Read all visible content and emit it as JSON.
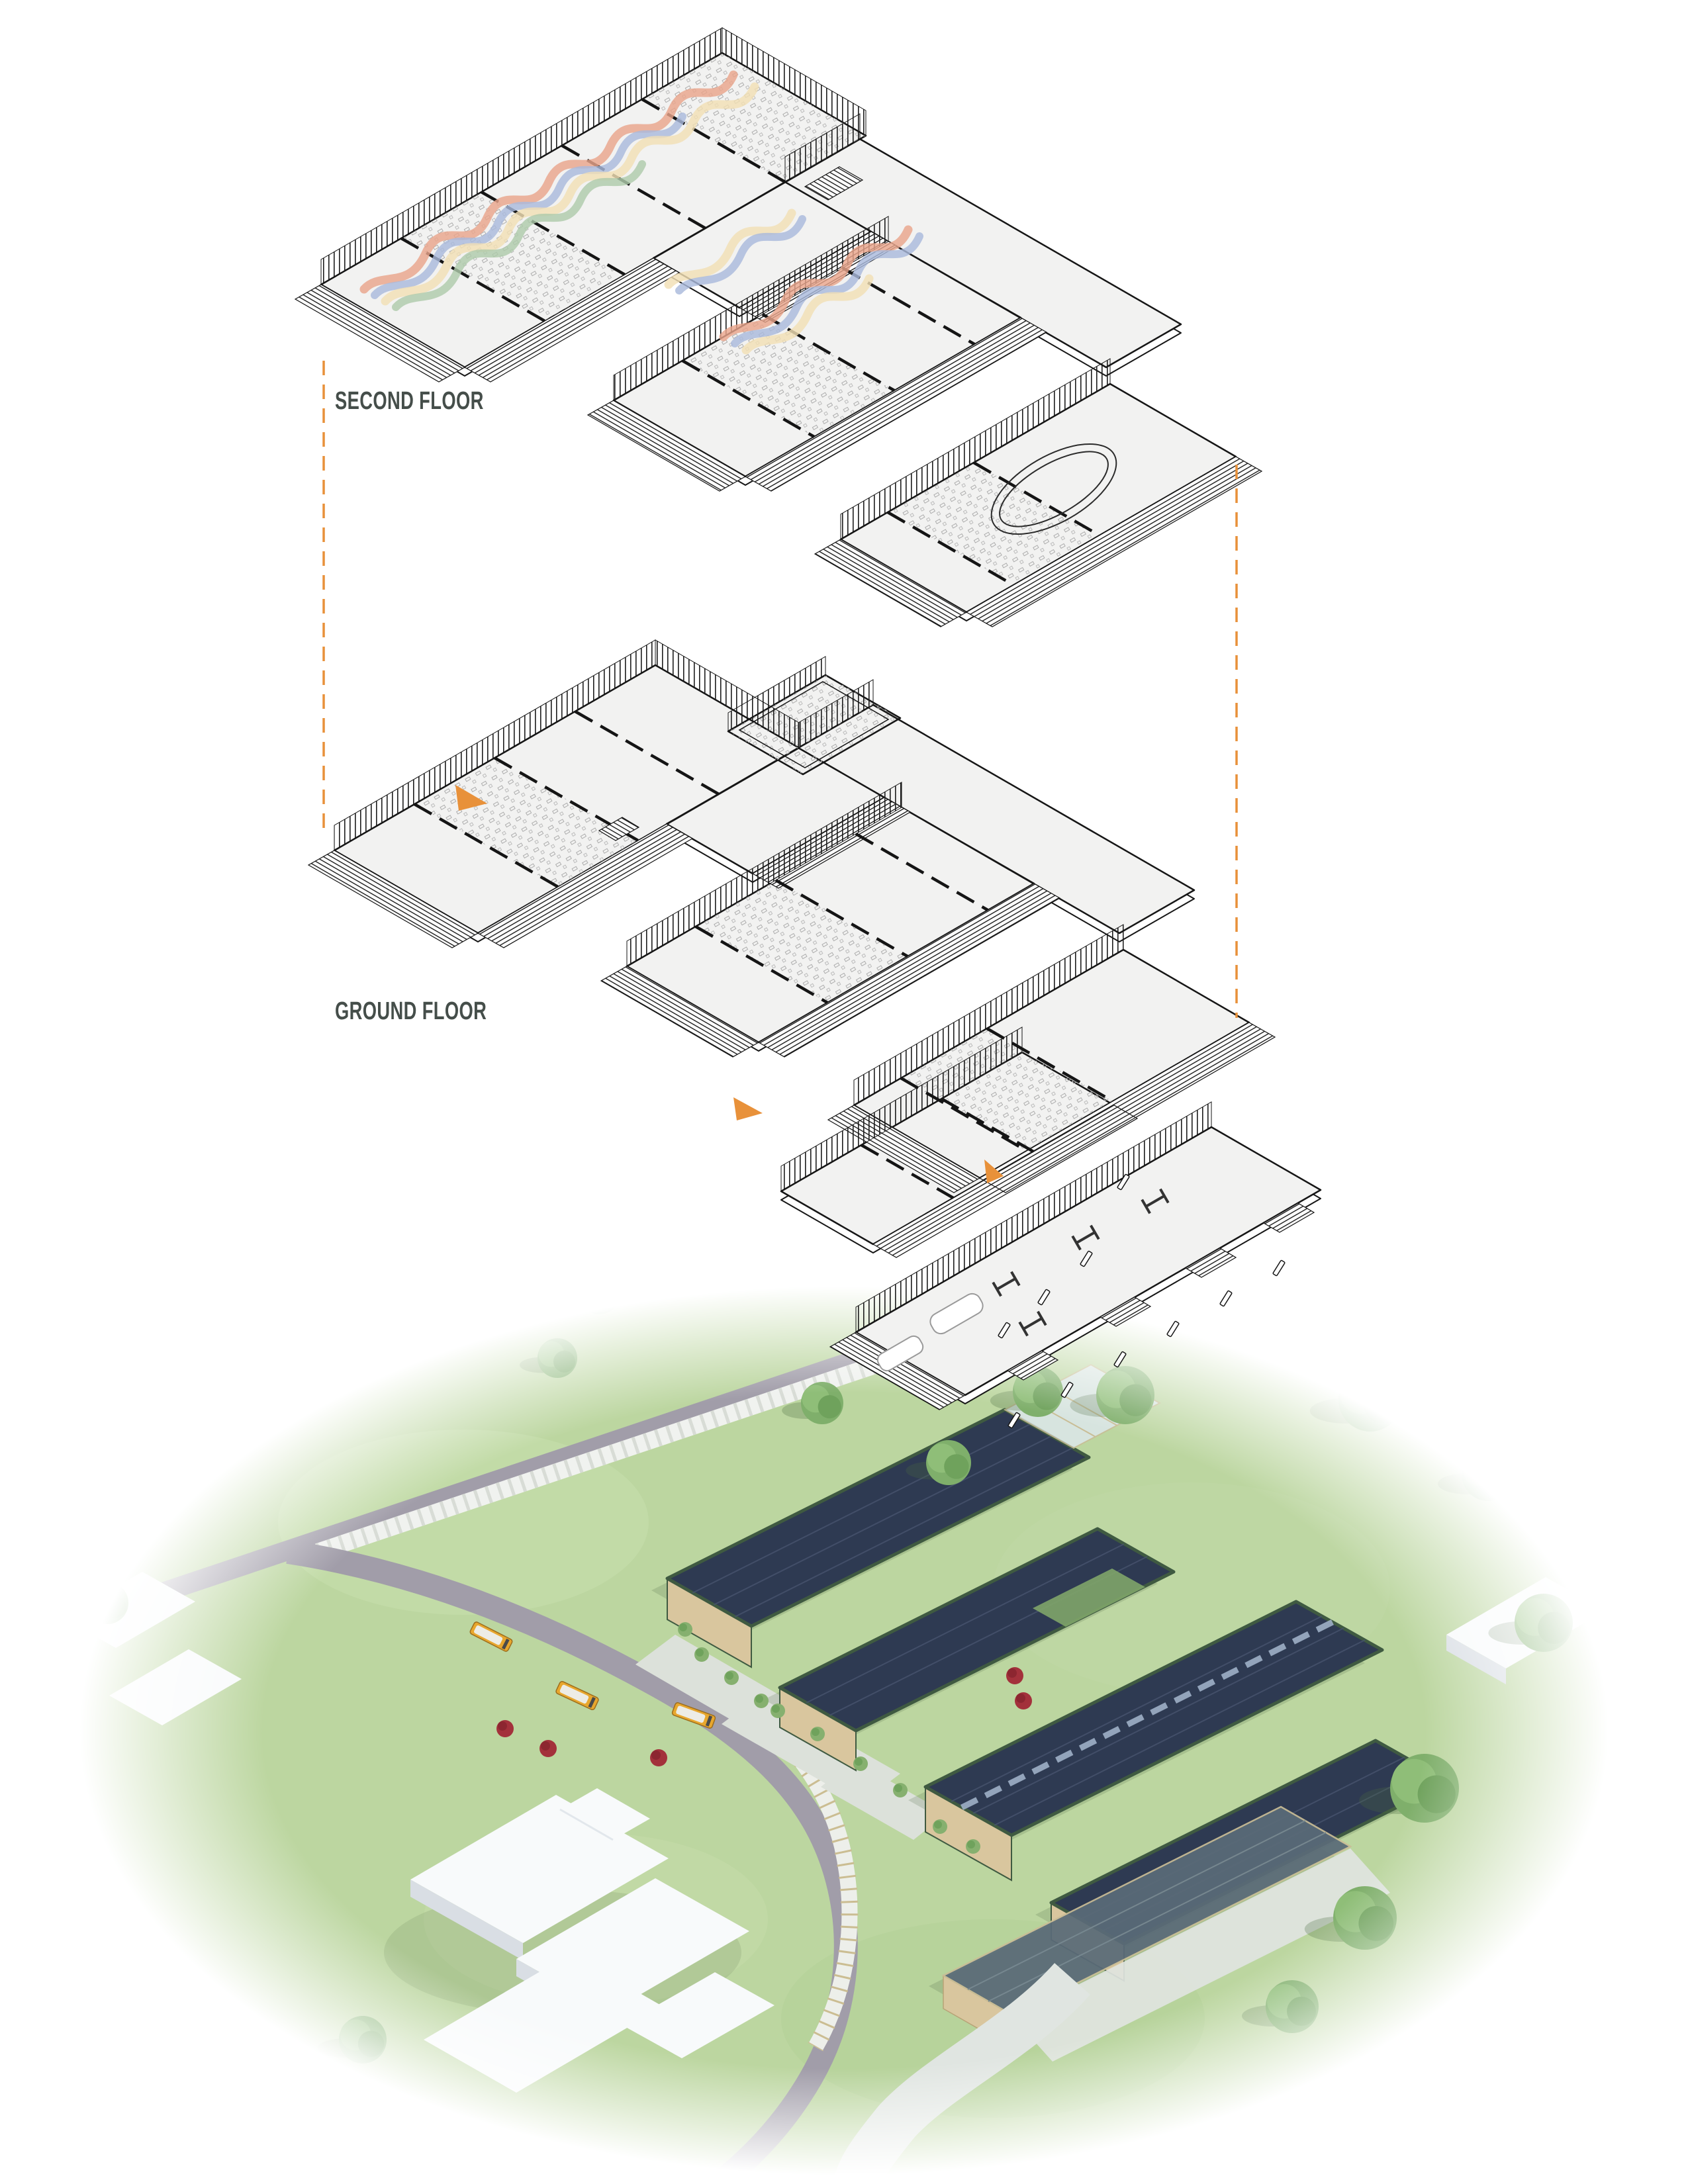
{
  "page": {
    "background": "#FFFFFF",
    "type": "architectural-exploded-axonometric-diagram"
  },
  "labels": {
    "second_floor": "SECOND FLOOR",
    "ground_floor": "GROUND FLOOR"
  },
  "palette": {
    "label_text": "#454E4A",
    "accent_orange": "#E8913A",
    "linework": "#161616",
    "floor_fill": "#F2F2F1",
    "ribbon_salmon": "#E9A58B",
    "ribbon_blue": "#AAB9DC",
    "ribbon_cream": "#F2DFB4",
    "ribbon_sage": "#AECBAB",
    "grass": "#BCD6A0",
    "road": "#A19DA9",
    "path_light": "#DFE4E0",
    "solar_roof": "#2E3A52",
    "roof_trim_green": "#3F5A41",
    "timber": "#D9C69E",
    "glass": "#DCE7EA",
    "pavilion_roof": "#5A6B78",
    "bus_yellow": "#E8A72E",
    "tree_green": "#7FAF6B",
    "shrub_red": "#A3313B",
    "context_white": "#F8FAFB",
    "context_shadow": "#D9DEE4"
  },
  "floors": [
    {
      "id": "second-floor",
      "label": "SECOND FLOOR",
      "features": [
        "classroom-bars",
        "central-spine",
        "stair",
        "running-track-oval",
        "colored-ribbon-mural",
        "louvered-facades"
      ]
    },
    {
      "id": "ground-floor",
      "label": "GROUND FLOOR",
      "features": [
        "classroom-bars",
        "central-spine",
        "greenhouse-pavilion",
        "entry-annex",
        "auto-workshop-wing",
        "louvered-facades"
      ]
    }
  ],
  "annotations": {
    "projection_lines": {
      "style": "dashed",
      "count": 2
    },
    "entrance_markers": {
      "icon": "entrance-arrow-icon",
      "count": 3
    }
  },
  "site_plan": {
    "setting": "campus-meadow-aerial",
    "school_buses": 3,
    "solar_roof_barns": 4,
    "greenhouse": 1,
    "open_pavilion": 1,
    "roads": [
      "tree-lined-road",
      "curved-access-loop"
    ],
    "landscape": [
      "lawns",
      "deciduous-trees",
      "red-shrubs",
      "garden-courtyards",
      "winding-path",
      "covered-walkway"
    ],
    "context": [
      "white-massing-school-building",
      "white-context-houses"
    ]
  }
}
